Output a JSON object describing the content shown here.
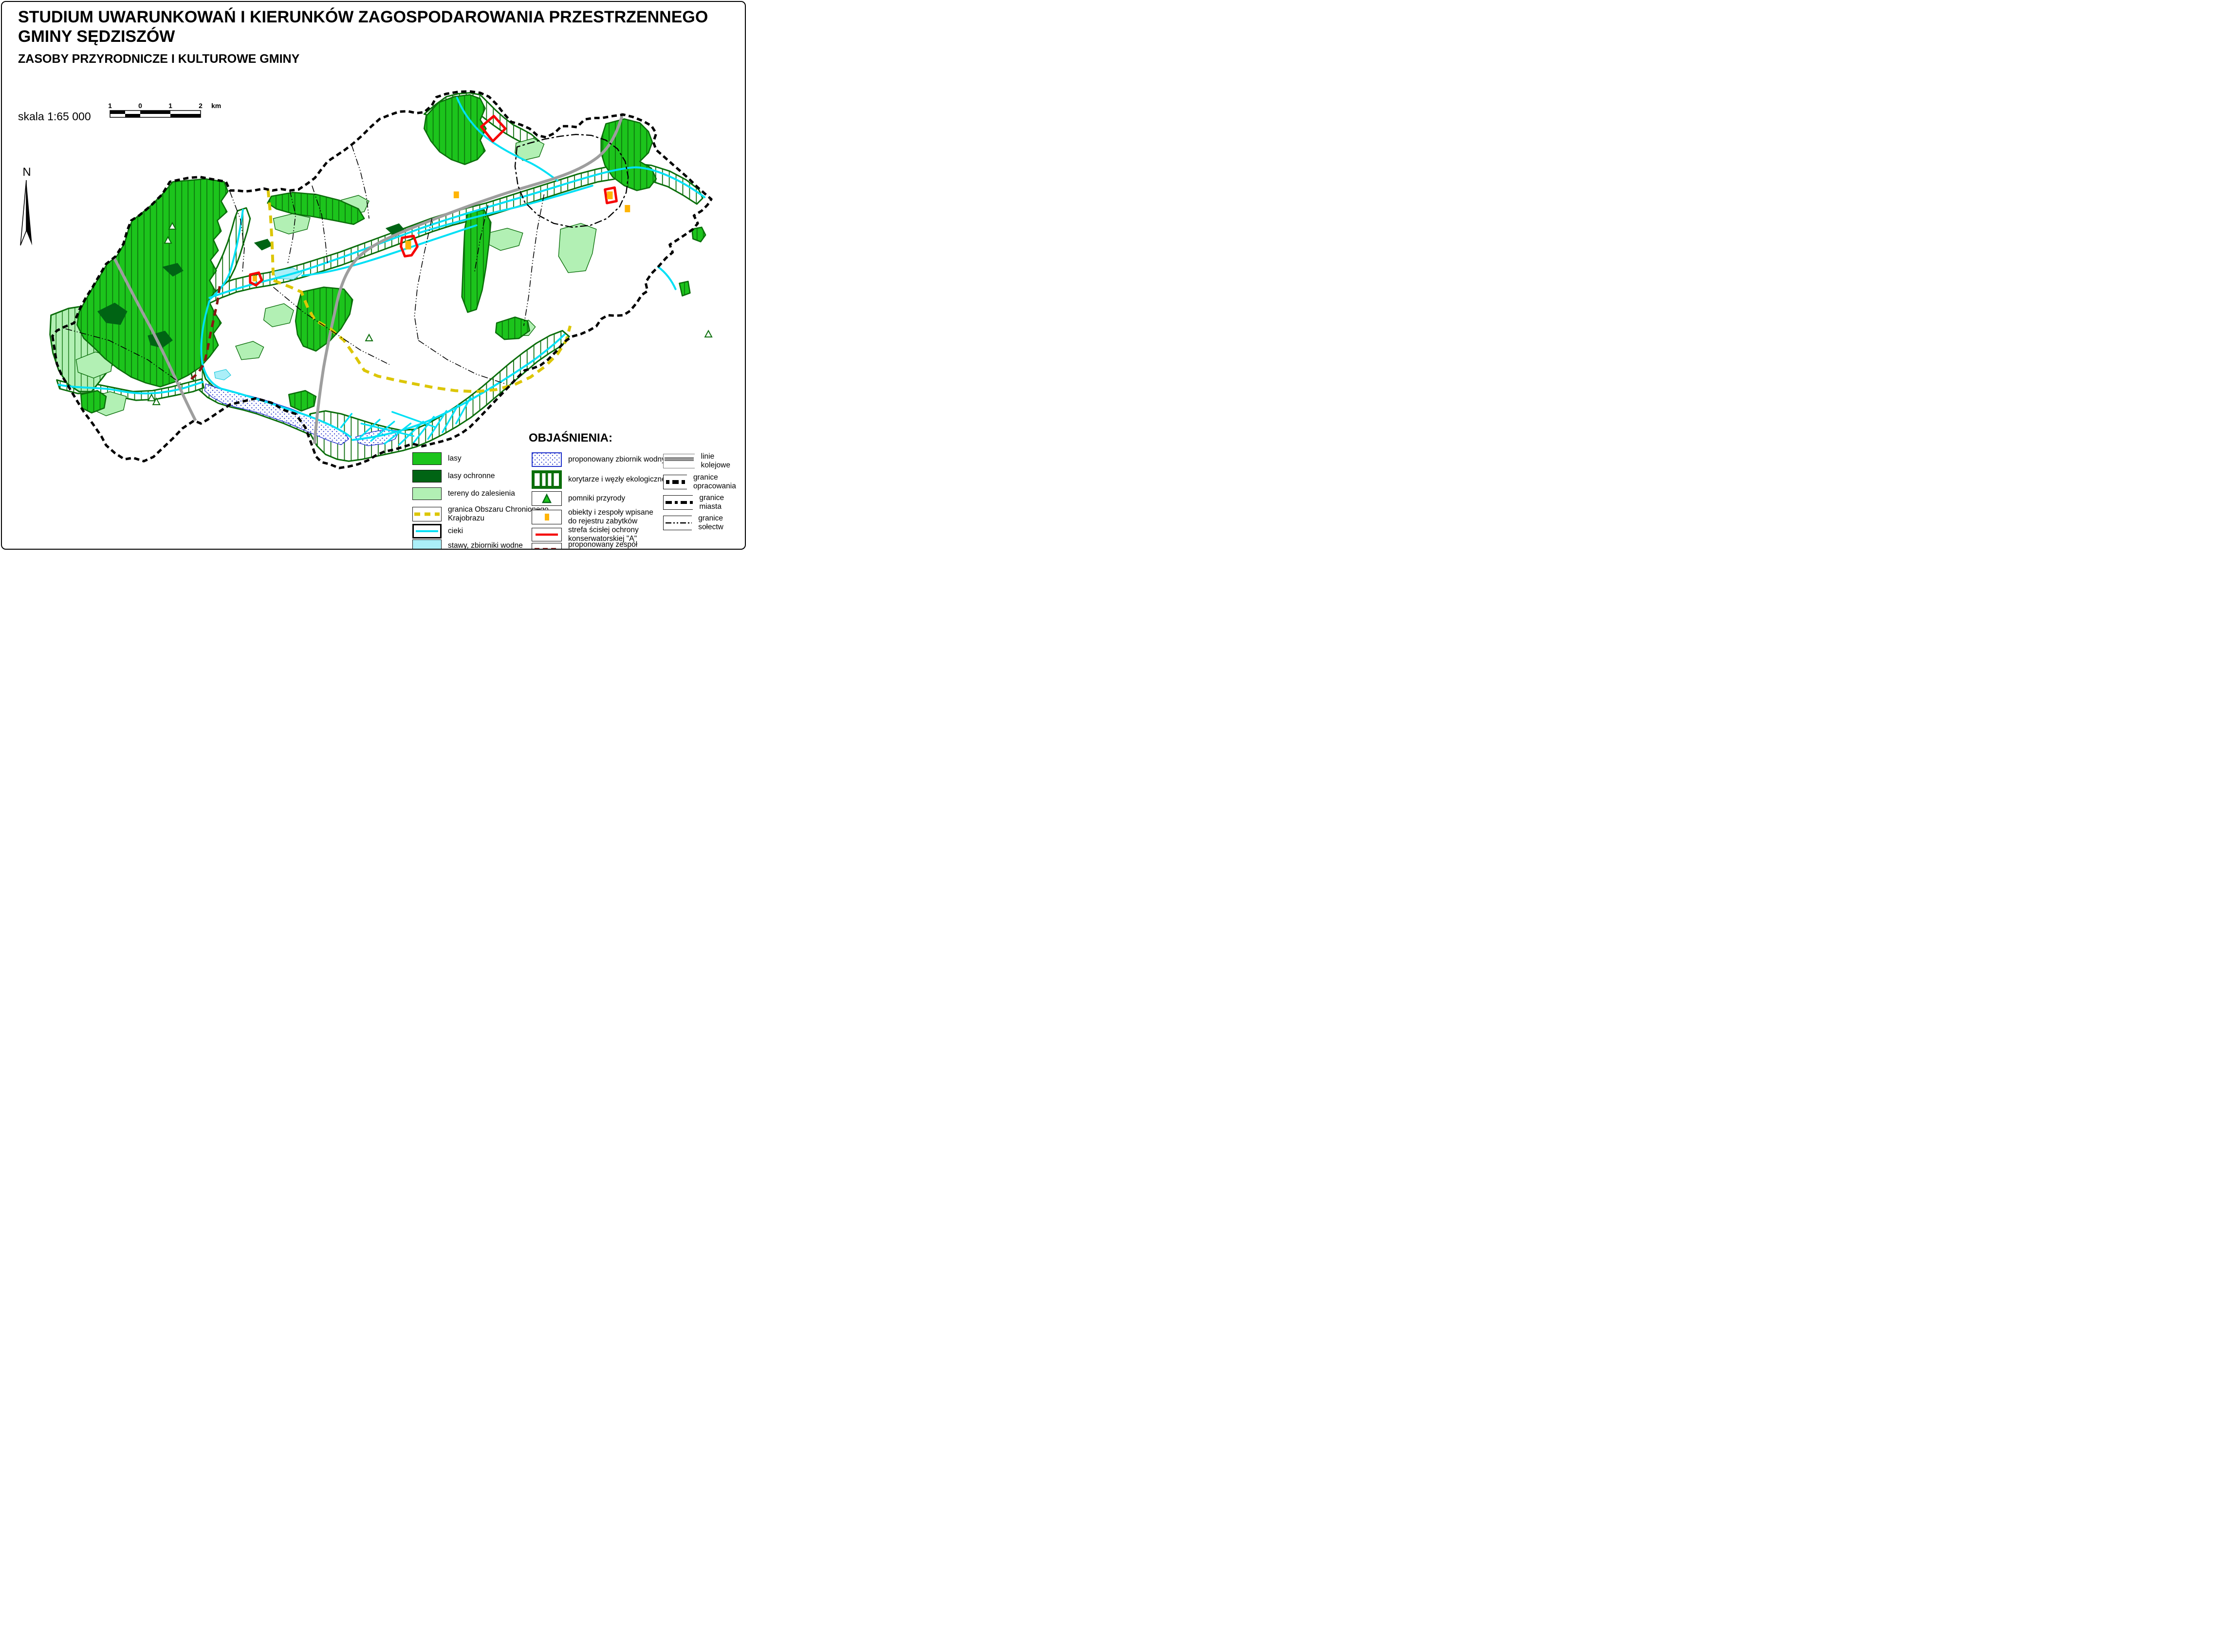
{
  "header": {
    "title_line1": "STUDIUM UWARUNKOWAŃ I KIERUNKÓW ZAGOSPODAROWANIA PRZESTRZENNEGO",
    "title_line2": "GMINY SĘDZISZÓW",
    "subtitle": "ZASOBY PRZYRODNICZE I KULTUROWE GMINY"
  },
  "scale": {
    "label": "skala 1:65 000",
    "ticks": [
      "1",
      "0",
      "1",
      "2"
    ],
    "unit": "km"
  },
  "north": {
    "label": "N"
  },
  "legend": {
    "title": "OBJAŚNIENIA:",
    "column1": [
      {
        "id": "lasy",
        "label": "lasy"
      },
      {
        "id": "lasy-ochronne",
        "label": "lasy ochronne"
      },
      {
        "id": "tereny-do-zalesienia",
        "label": "tereny do zalesienia"
      },
      {
        "id": "granica-ochk",
        "label": "granica Obszaru Chronionego\nKrajobrazu"
      },
      {
        "id": "cieki",
        "label": "cieki"
      },
      {
        "id": "stawy",
        "label": "stawy, zbiorniki wodne"
      }
    ],
    "column2": [
      {
        "id": "zbiornik-proponowany",
        "label": "proponowany zbiornik wodny"
      },
      {
        "id": "korytarze",
        "label": "korytarze  i węzły ekologiczne"
      },
      {
        "id": "pomniki-przyrody",
        "label": "pomniki  przyrody"
      },
      {
        "id": "zabytki",
        "label": "obiekty i zespoły wpisane\ndo rejestru zabytków"
      },
      {
        "id": "strefa-a",
        "label": "strefa ścisłej ochrony\nkonserwatorskiej \"A\""
      },
      {
        "id": "zespol-przyrodniczo-krajobrazowy",
        "label": "proponowany zespół\nprzyrodniczo-krajobrazowy"
      }
    ],
    "column3": [
      {
        "id": "linie-kolejowe",
        "label": "linie kolejowe"
      },
      {
        "id": "granice-opracowania",
        "label": "granice opracowania"
      },
      {
        "id": "granice-miasta",
        "label": "granice miasta"
      },
      {
        "id": "granice-solectw",
        "label": "granice sołectw"
      }
    ]
  },
  "colors": {
    "forest": "#1cc41c",
    "forest_protected": "#006414",
    "afforestation": "#b2f0b4",
    "stream": "#00e0f5",
    "pond": "#abeff8",
    "ochk_boundary": "#dcc605",
    "reservoir_dots": "#2233cc",
    "corridor_green": "#0b6e0b",
    "heritage_orange": "#ffb405",
    "strict_zone_red": "#f50505",
    "nature_landscape_darkred": "#8b1414",
    "railway_gray": "#9e9e9e",
    "boundary_black": "#000000"
  }
}
